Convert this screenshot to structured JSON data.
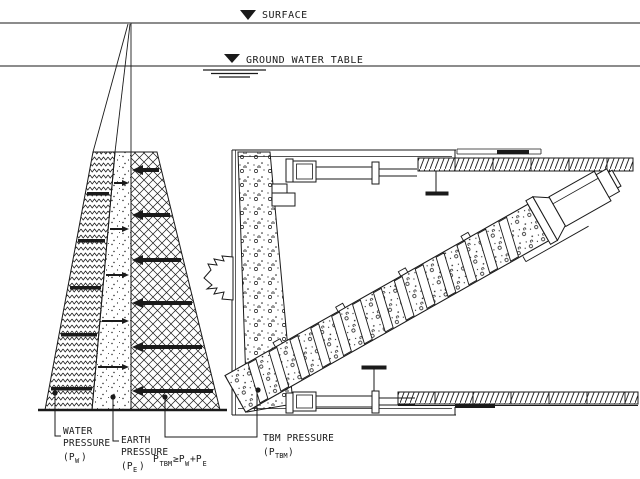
{
  "drawing_title": "TBM face pressure balance diagram",
  "colors": {
    "ink": "#1a1a1a",
    "background": "#ffffff"
  },
  "labels": {
    "surface": "SURFACE",
    "ground_water_table": "GROUND WATER TABLE",
    "water_pressure": {
      "line1": "WATER",
      "line2": "PRESSURE",
      "sym_open": "(P",
      "sym_sub": "W",
      "sym_close": ")"
    },
    "earth_pressure": {
      "line1": "EARTH",
      "line2": "PRESSURE",
      "sym_open": "(P",
      "sym_sub": "E",
      "sym_close": ")"
    },
    "tbm_pressure": {
      "line1": "TBM PRESSURE",
      "sym_open": "(P",
      "sym_sub": "TBM",
      "sym_close": ")"
    },
    "formula": {
      "t1": "P",
      "s1": "TBM",
      "t2": "≥P",
      "s2": "W",
      "t3": "+P",
      "s3": "E"
    }
  },
  "icons": {
    "surface_marker": "down-triangle-datum-icon",
    "gwt_marker": "down-triangle-datum-icon",
    "muck_flow": "jagged-block-arrow-icon"
  }
}
